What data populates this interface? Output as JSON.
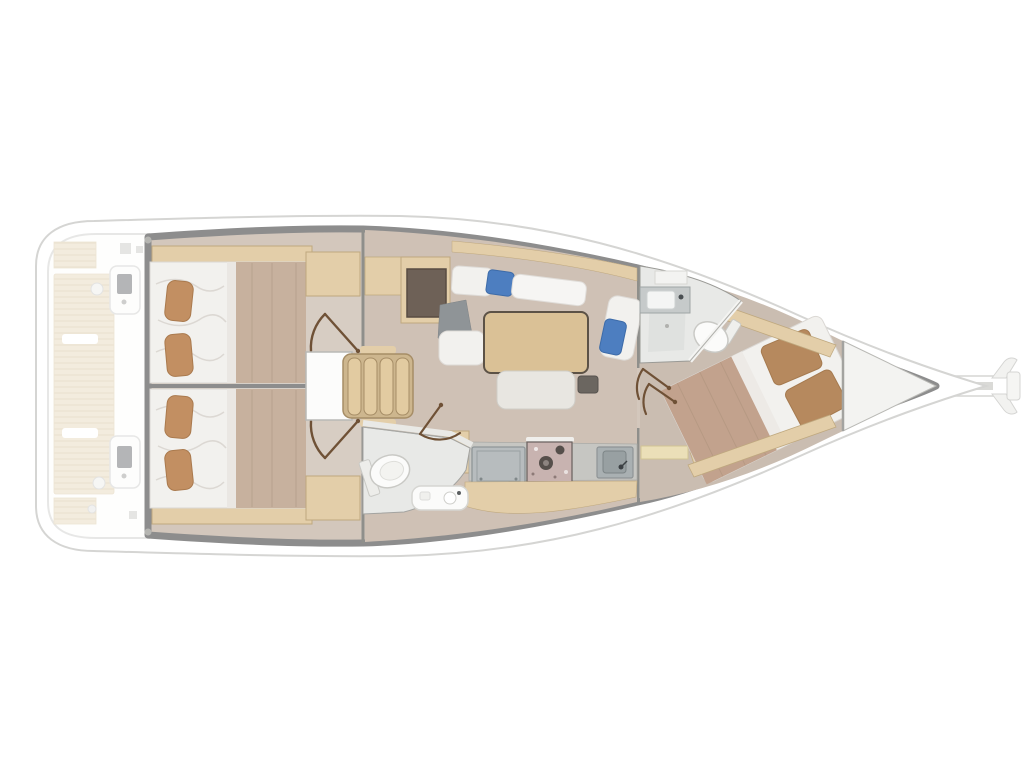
{
  "figure": {
    "type": "boat-floorplan",
    "subject": "Sailing yacht interior layout, top-down deck plan",
    "orientation": "stern-left, bow-right",
    "rooms": [
      "swim-platform-and-cockpit (ghosted)",
      "aft-cabin-port (double berth)",
      "aft-cabin-starboard (double berth)",
      "companionway-steps",
      "aft-head (toilet + vanity)",
      "salon (U-settee, table, bench)",
      "chart-table",
      "galley (fridge, stove, sink)",
      "forward-head (sink, shower, toilet)",
      "forward-cabin (island berth)",
      "anchor-locker",
      "bowsprit"
    ]
  },
  "palette": {
    "hullOutline": "#d5d5d3",
    "hullFill": "#ffffff",
    "band": "#8d8d8d",
    "bulkhead": "#8f8f8b",
    "floor": "#d3c7bc",
    "salonFloor": "#cfc1b5",
    "fwdFloor": "#cabdb1",
    "vestibule": "#d7cdc3",
    "wood": "#e3cea9",
    "woodEdge": "#bfa87e",
    "bedWhite": "#f2f1ee",
    "bedEdge": "#dbd8d4",
    "pillowTan": "#c28f62",
    "pillowEdge": "#aa7a4e",
    "blanket": "#c7b19e",
    "blanketFold": "#b7a28e",
    "sheet": "#eae7e3",
    "fwdBlanket": "#c2a28d",
    "fwdPillow": "#b6895e",
    "blue": "#4d7ec0",
    "grayCushion": "#8f9497",
    "tableWood": "#dac196",
    "tableEdge": "#5c5246",
    "stepsWood": "#cdb68e",
    "stepTread": "#e2cba1",
    "stepEdge": "#a68d66",
    "door": "#6f5136",
    "desk": "#6e6157",
    "counter": "#c6c6c2",
    "appliance": "#b7bcbe",
    "sink": "#a9b0b2",
    "stove": "#c8b3b0",
    "teak": "#e8d9bc",
    "teakLine": "#d7c3a0",
    "fixture": "#fbfbfa",
    "fixtureEdge": "#c9c9c5",
    "locker": "#f3f3f1",
    "headFloor": "#e8e9e7"
  }
}
